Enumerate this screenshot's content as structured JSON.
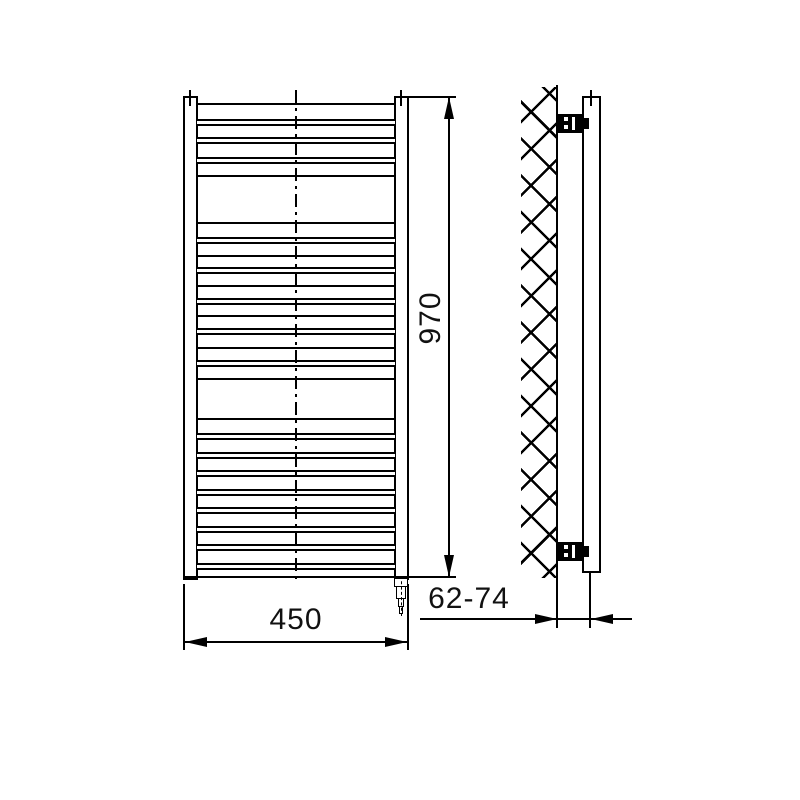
{
  "labels": {
    "height": "970",
    "width": "450",
    "wall_distance": "62-74"
  }
}
